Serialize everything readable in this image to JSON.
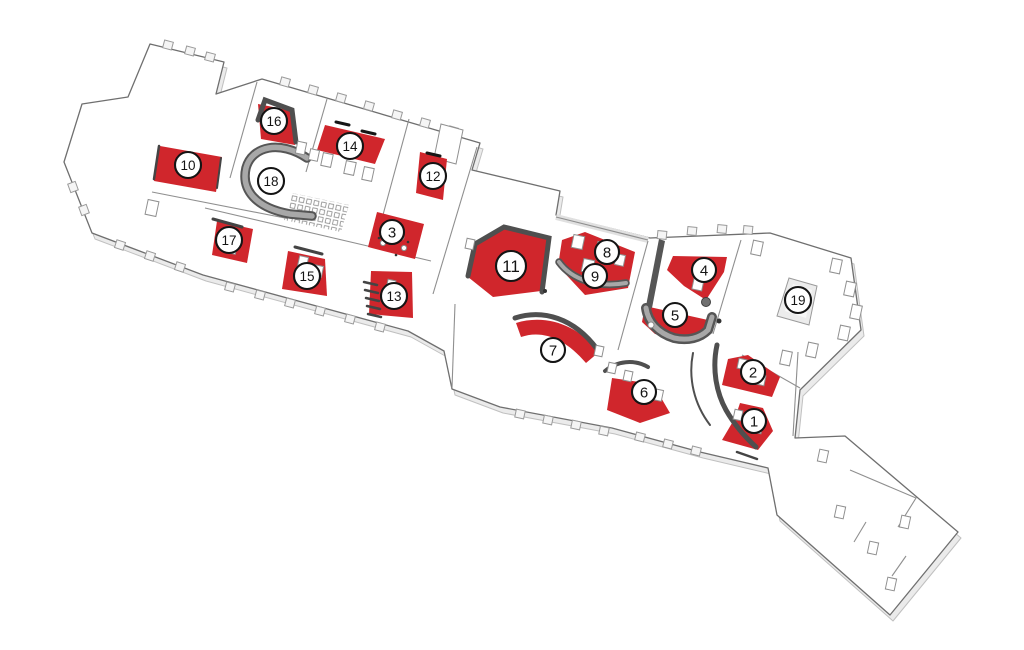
{
  "diagram": {
    "type": "isometric-floor-plan",
    "description": "Axonometric building floor plan with numbered location markers; highlighted areas shown in red",
    "colors": {
      "highlight": "#d0262c",
      "wall_dark": "#4f4f4f",
      "wall_mid": "#9a9a9a",
      "wall_light": "#e6e6e6",
      "outline": "#6f6f6f",
      "floor": "#ffffff",
      "marker_fill": "#ffffff",
      "marker_stroke": "#141414",
      "marker_text": "#141414"
    },
    "markers": [
      {
        "label": "1",
        "x": 754,
        "y": 421,
        "r": 12,
        "highlighted": true
      },
      {
        "label": "2",
        "x": 753,
        "y": 372,
        "r": 12,
        "highlighted": true
      },
      {
        "label": "3",
        "x": 392,
        "y": 232,
        "r": 12,
        "highlighted": true
      },
      {
        "label": "4",
        "x": 704,
        "y": 270,
        "r": 12,
        "highlighted": true
      },
      {
        "label": "5",
        "x": 675,
        "y": 315,
        "r": 12,
        "highlighted": true
      },
      {
        "label": "6",
        "x": 644,
        "y": 392,
        "r": 12,
        "highlighted": true
      },
      {
        "label": "7",
        "x": 553,
        "y": 350,
        "r": 12,
        "highlighted": true
      },
      {
        "label": "8",
        "x": 607,
        "y": 252,
        "r": 12,
        "highlighted": true
      },
      {
        "label": "9",
        "x": 595,
        "y": 276,
        "r": 12,
        "highlighted": true
      },
      {
        "label": "10",
        "x": 188,
        "y": 165,
        "r": 13,
        "highlighted": true
      },
      {
        "label": "11",
        "x": 511,
        "y": 266,
        "r": 15,
        "highlighted": true
      },
      {
        "label": "12",
        "x": 433,
        "y": 176,
        "r": 13,
        "highlighted": true
      },
      {
        "label": "13",
        "x": 394,
        "y": 296,
        "r": 13,
        "highlighted": true
      },
      {
        "label": "14",
        "x": 350,
        "y": 146,
        "r": 13,
        "highlighted": true
      },
      {
        "label": "15",
        "x": 307,
        "y": 276,
        "r": 13,
        "highlighted": true
      },
      {
        "label": "16",
        "x": 274,
        "y": 121,
        "r": 13,
        "highlighted": true
      },
      {
        "label": "17",
        "x": 229,
        "y": 240,
        "r": 13,
        "highlighted": true
      },
      {
        "label": "18",
        "x": 271,
        "y": 181,
        "r": 13,
        "highlighted": false
      },
      {
        "label": "19",
        "x": 798,
        "y": 300,
        "r": 13,
        "highlighted": false
      }
    ]
  }
}
